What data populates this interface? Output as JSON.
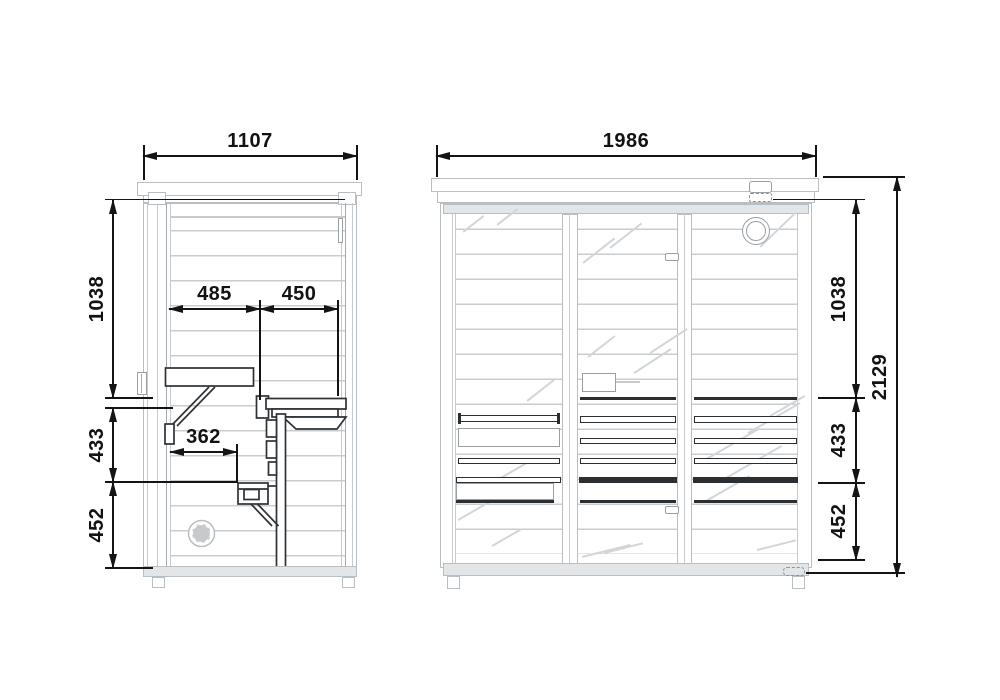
{
  "drawing": {
    "type": "sauna cabin dimensional drawing",
    "side_view": {
      "width": "1107",
      "heights": {
        "upper": "1038",
        "middle": "433",
        "lower": "452"
      },
      "bench": {
        "seat_depth_back": "485",
        "seat_depth_front": "450",
        "step_depth": "362"
      }
    },
    "front_view": {
      "width": "1986",
      "total_height": "2129",
      "heights": {
        "upper": "1038",
        "middle": "433",
        "lower": "452"
      }
    },
    "colors": {
      "structure_line": "#b9bec2",
      "bench_line": "#2b2f32",
      "dimension_line": "#141414",
      "heater_fill": "#c6cacd"
    }
  }
}
